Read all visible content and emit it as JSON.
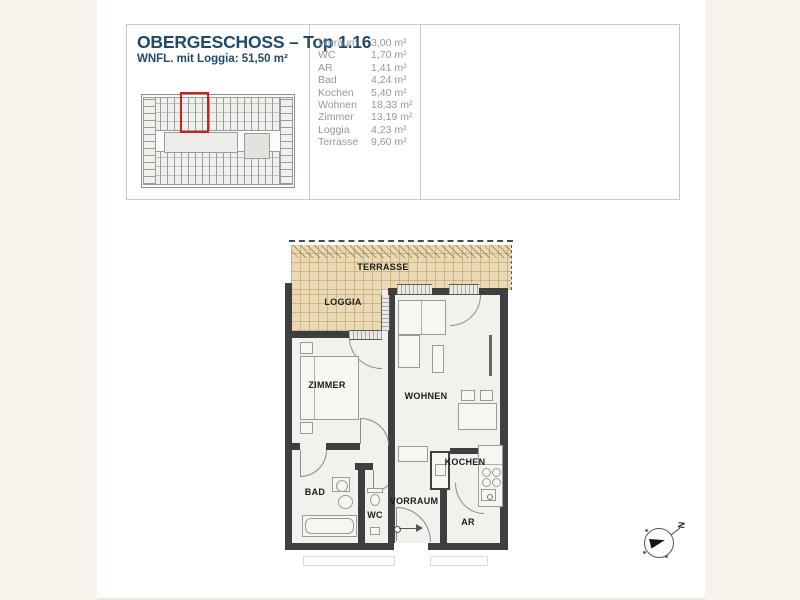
{
  "header": {
    "title": "OBERGESCHOSS – Top 1.16",
    "subtitle": "WNFL. mit Loggia: 51,50 m²",
    "rooms": [
      {
        "name": "Vorraum",
        "area": "3,00 m²"
      },
      {
        "name": "WC",
        "area": "1,70 m²"
      },
      {
        "name": "AR",
        "area": "1,41 m²"
      },
      {
        "name": "Bad",
        "area": "4,24 m²"
      },
      {
        "name": "Kochen",
        "area": "5,40 m²"
      },
      {
        "name": "Wohnen",
        "area": "18,33 m²"
      },
      {
        "name": "Zimmer",
        "area": "13,19 m²"
      },
      {
        "name": "Loggia",
        "area": "4,23 m²"
      },
      {
        "name": "Terrasse",
        "area": "9,60 m²"
      }
    ]
  },
  "plan": {
    "labels": {
      "terrasse": "TERRASSE",
      "loggia": "LOGGIA",
      "zimmer": "ZIMMER",
      "wohnen": "WOHNEN",
      "bad": "BAD",
      "wc": "WC",
      "vorraum": "VORRAUM",
      "kochen": "KOCHEN",
      "ar": "AR"
    },
    "compass_label": "N"
  },
  "colors": {
    "accent_blue": "#1f4a6e",
    "highlight_red": "#c4261f",
    "terrace_tan": "#ead9b4",
    "wall_dark": "#3f3f3f",
    "list_gray": "#979797",
    "background_cream": "#f7f4ee"
  }
}
